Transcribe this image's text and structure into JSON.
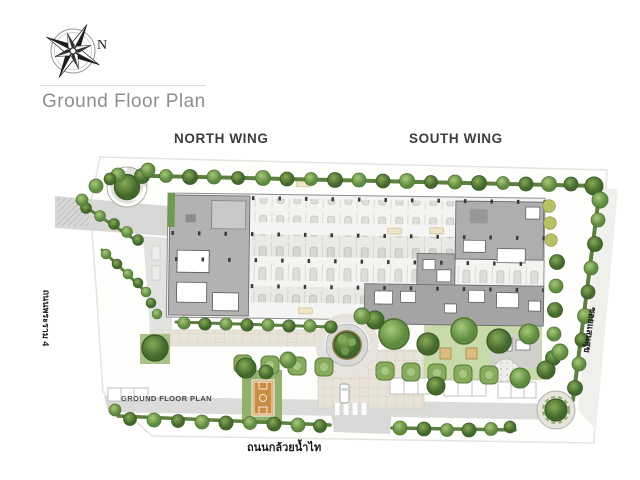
{
  "header": {
    "title": "Ground Floor Plan",
    "compass_label": "N"
  },
  "plan": {
    "wings": {
      "north": "NORTH WING",
      "south": "SOUTH WING"
    },
    "caption": "GROUND FLOOR PLAN",
    "streets": {
      "bottom": "ถนนกล้วยน้ำไท",
      "left": "ถนนพระราม 4",
      "right": "ซอยแสนสุข"
    }
  },
  "colors": {
    "tree_green": "#6f9a4f",
    "hedge_green": "#5d7f3f",
    "building_gray": "#b2b2b2",
    "parking_light": "#f3f3f0",
    "road_gray": "#d9d9d7",
    "court_orange": "#c98d44",
    "roundabout_tan": "#bda06a",
    "lawn_green": "#a9c184",
    "title_gray": "#8f8f8f",
    "label_dark": "#3d3d3d"
  }
}
